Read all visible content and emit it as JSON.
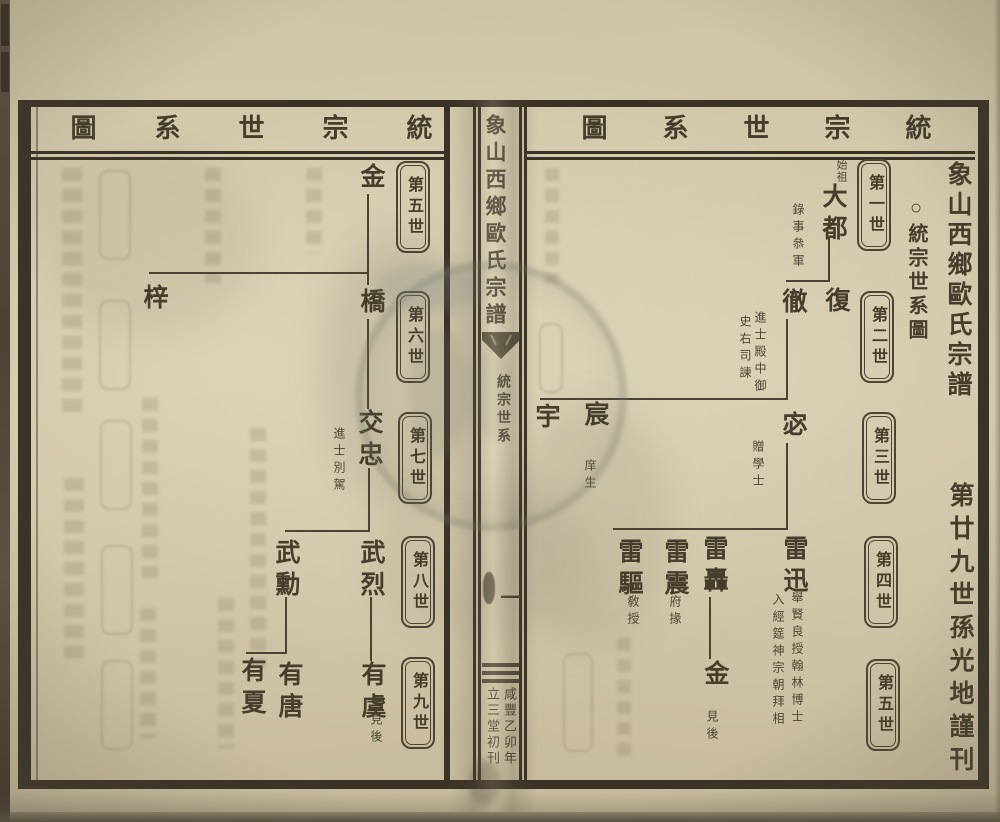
{
  "page_header": {
    "left": "統宗世系圖",
    "right": "統宗世系圖"
  },
  "center_fold": {
    "book_title": "象山西鄉歐氏宗譜",
    "section_label": "統宗世系",
    "page_number": "一",
    "colophon_year": "咸豐乙卯年",
    "colophon_hall": "立三堂初刊"
  },
  "right_page": {
    "title": "象山西鄉歐氏宗譜",
    "subtitle": "○統宗世系圖",
    "publisher": "第廿九世孫光地謹刊",
    "generation_badges": [
      "第一世",
      "第二世",
      "第三世",
      "第四世",
      "第五世"
    ],
    "people": {
      "dadu": {
        "label": "始祖",
        "name": "大都",
        "note": "錄事叅軍"
      },
      "fu": {
        "name": "復"
      },
      "che": {
        "name": "徹",
        "note_a": "進士殿中御",
        "note_b": "史右司諫"
      },
      "mi": {
        "name": "宓",
        "note": "贈學士"
      },
      "chen": {
        "name": "宸",
        "note": "庠生"
      },
      "yu": {
        "name": "宇"
      },
      "leixun": {
        "name": "雷迅",
        "note_a": "舉賢良授翰林博士",
        "note_b": "入經筵神宗朝拜相"
      },
      "leihong": {
        "name": "雷轟"
      },
      "leizhen": {
        "name": "雷震",
        "note": "府掾"
      },
      "leiqu": {
        "name": "雷驅",
        "note": "敎授"
      },
      "jin": {
        "name": "金",
        "note": "見後"
      }
    }
  },
  "left_page": {
    "generation_badges": [
      "第五世",
      "第六世",
      "第七世",
      "第八世",
      "第九世"
    ],
    "people": {
      "jin": {
        "name": "金"
      },
      "qiao": {
        "name": "橋"
      },
      "zi": {
        "name": "梓"
      },
      "jiaozhong": {
        "name": "交忠",
        "note": "進士別駕"
      },
      "wulie": {
        "name": "武烈"
      },
      "wuxun": {
        "name": "武勳"
      },
      "youyu": {
        "name": "有虞",
        "note": "見後"
      },
      "youtang": {
        "name": "有唐"
      },
      "youxia": {
        "name": "有夏"
      }
    }
  },
  "colors": {
    "paper": "#cfc4a6",
    "ink": "#453e2c",
    "frame": "#393327",
    "stamp": "#707866"
  }
}
